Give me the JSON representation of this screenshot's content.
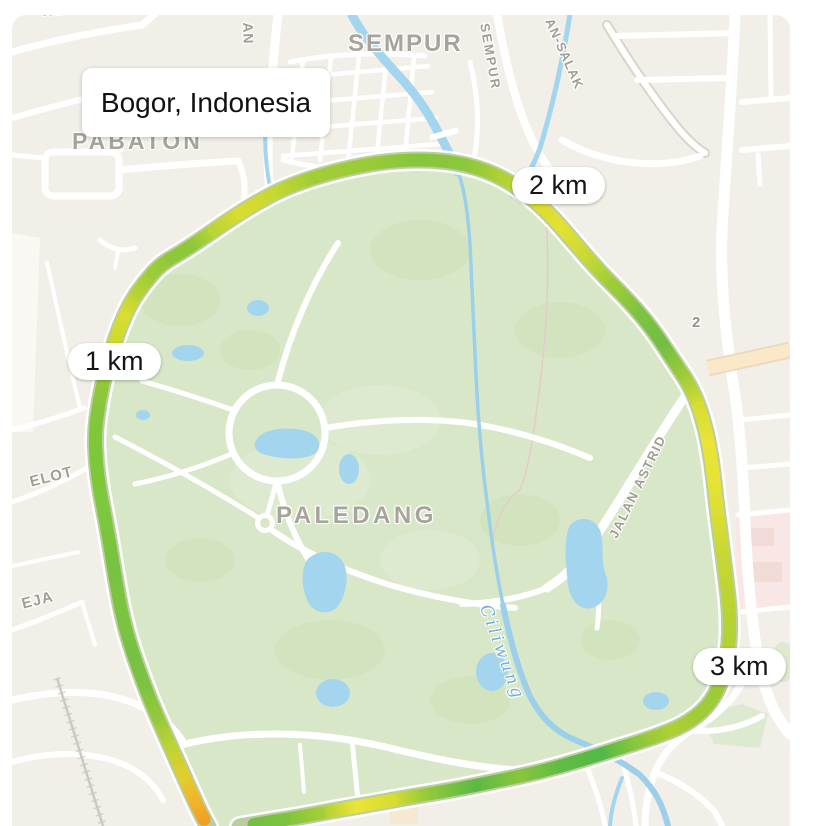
{
  "location_card": {
    "label": "Bogor, Indonesia",
    "x": 82,
    "y": 68,
    "w": 248,
    "h": 69
  },
  "distance_markers": [
    {
      "label": "1 km",
      "x": 68,
      "y": 343
    },
    {
      "label": "2 km",
      "x": 512,
      "y": 167
    },
    {
      "label": "3 km",
      "x": 693,
      "y": 648
    }
  ],
  "map_labels": [
    {
      "text": "PABATON",
      "x": 72,
      "y": 128,
      "rot": 0,
      "cls": "area",
      "size": 23,
      "ls": 3
    },
    {
      "text": "SEMPUR",
      "x": 348,
      "y": 30,
      "rot": 0,
      "cls": "area",
      "size": 24,
      "ls": 2
    },
    {
      "text": "PALEDANG",
      "x": 276,
      "y": 502,
      "rot": 0,
      "cls": "area",
      "size": 24,
      "ls": 3.5
    },
    {
      "text": "JALAN ASTRID",
      "x": 606,
      "y": 534,
      "rot": -64,
      "cls": "street",
      "size": 13,
      "ls": 1.5
    },
    {
      "text": "Ciliwung",
      "x": 494,
      "y": 602,
      "rot": 70,
      "cls": "water",
      "size": 17,
      "ls": 3
    },
    {
      "text": "SEMPUR",
      "x": 492,
      "y": 22,
      "rot": 80,
      "cls": "street",
      "size": 13,
      "ls": 2
    },
    {
      "text": "AN-SALAK",
      "x": 556,
      "y": 16,
      "rot": 66,
      "cls": "street",
      "size": 13,
      "ls": 1
    },
    {
      "text": "AN",
      "x": 256,
      "y": 22,
      "rot": 88,
      "cls": "street",
      "size": 14,
      "ls": 1
    },
    {
      "text": "NG BATU",
      "x": 42,
      "y": 3,
      "rot": -4,
      "cls": "street",
      "size": 14,
      "ls": 1
    },
    {
      "text": "ELOT",
      "x": 28,
      "y": 474,
      "rot": -14,
      "cls": "street",
      "size": 15,
      "ls": 1
    },
    {
      "text": "EJA",
      "x": 20,
      "y": 596,
      "rot": -14,
      "cls": "street",
      "size": 15,
      "ls": 1
    },
    {
      "text": "2",
      "x": 692,
      "y": 314,
      "rot": 0,
      "cls": "shield",
      "size": 15,
      "ls": 0
    }
  ],
  "route": {
    "width": 13,
    "underlay_width": 22,
    "outline_width": 17,
    "points": [
      [
        208,
        827,
        "#F0A125"
      ],
      [
        200,
        812,
        "#F2B32A"
      ],
      [
        190,
        790,
        "#E3CD2E"
      ],
      [
        178,
        763,
        "#BFD433"
      ],
      [
        164,
        732,
        "#93C93C"
      ],
      [
        150,
        700,
        "#7DC341"
      ],
      [
        138,
        668,
        "#76C044"
      ],
      [
        128,
        638,
        "#7CC43F"
      ],
      [
        121,
        610,
        "#7CC43F"
      ],
      [
        116,
        582,
        "#78C242"
      ],
      [
        111,
        552,
        "#7CC43F"
      ],
      [
        106,
        522,
        "#7DC83E"
      ],
      [
        100,
        492,
        "#7DC838"
      ],
      [
        96,
        462,
        "#7DC838"
      ],
      [
        95,
        432,
        "#84C63C"
      ],
      [
        99,
        402,
        "#8EC83A"
      ],
      [
        105,
        374,
        "#ABD035"
      ],
      [
        112,
        350,
        "#CFDA2F"
      ],
      [
        120,
        326,
        "#DADD30"
      ],
      [
        131,
        302,
        "#B6D234"
      ],
      [
        145,
        282,
        "#9ECC38"
      ],
      [
        161,
        264,
        "#8EC83A"
      ],
      [
        182,
        252,
        "#8EC83A"
      ],
      [
        203,
        238,
        "#BCD434"
      ],
      [
        226,
        222,
        "#DADC2F"
      ],
      [
        254,
        204,
        "#C8D832"
      ],
      [
        288,
        186,
        "#A3CD37"
      ],
      [
        338,
        170,
        "#9BCB39"
      ],
      [
        392,
        160,
        "#86C53E"
      ],
      [
        445,
        160,
        "#8DC73C"
      ],
      [
        487,
        170,
        "#B0D134"
      ],
      [
        520,
        188,
        "#D8DC31"
      ],
      [
        548,
        212,
        "#E4E133"
      ],
      [
        574,
        242,
        "#CAD934"
      ],
      [
        598,
        270,
        "#9ECC38"
      ],
      [
        628,
        300,
        "#7DC341"
      ],
      [
        652,
        328,
        "#73BE45"
      ],
      [
        673,
        360,
        "#9BCB39"
      ],
      [
        693,
        390,
        "#D9DD32"
      ],
      [
        705,
        425,
        "#E9E437"
      ],
      [
        712,
        462,
        "#E7E335"
      ],
      [
        716,
        500,
        "#D9DD32"
      ],
      [
        721,
        540,
        "#C5D734"
      ],
      [
        726,
        578,
        "#BDD434"
      ],
      [
        730,
        615,
        "#B5D236"
      ],
      [
        729,
        650,
        "#ABCF36"
      ],
      [
        722,
        682,
        "#9DCB38"
      ],
      [
        708,
        707,
        "#A0CC36"
      ],
      [
        685,
        725,
        "#AFD032"
      ],
      [
        655,
        737,
        "#8DC73C"
      ],
      [
        620,
        748,
        "#54B946"
      ],
      [
        582,
        760,
        "#60BC43"
      ],
      [
        540,
        772,
        "#88C53D"
      ],
      [
        497,
        781,
        "#5CBA44"
      ],
      [
        453,
        790,
        "#8DC73C"
      ],
      [
        410,
        797,
        "#D9DD32"
      ],
      [
        372,
        804,
        "#E9E437"
      ],
      [
        337,
        810,
        "#A3CD37"
      ],
      [
        300,
        817,
        "#7DC341"
      ],
      [
        268,
        822,
        "#73BE45"
      ],
      [
        240,
        827,
        "#70BD45"
      ]
    ]
  },
  "colors": {
    "land": "#F2EFE8",
    "park": "#D8E7C8",
    "water": "#A3D5EE",
    "road": "#FFFFFF",
    "route_outline": "rgba(92,138,30,0.42)",
    "marker_bg": "#FFFFFF",
    "marker_text": "#161616"
  }
}
